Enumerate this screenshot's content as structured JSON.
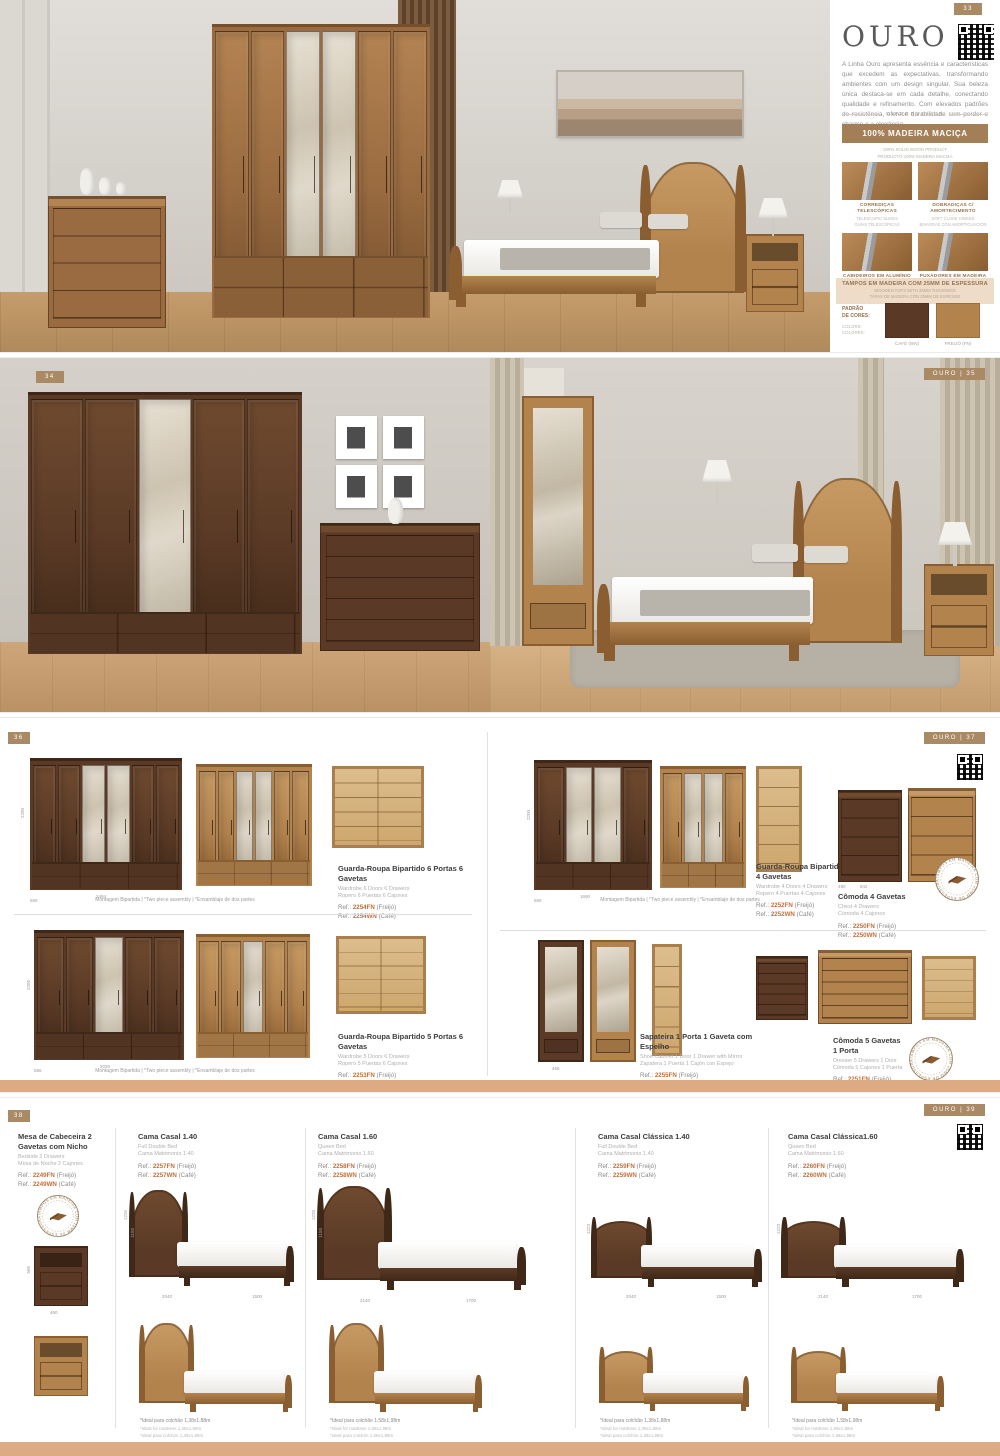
{
  "badges": {
    "p1": "33",
    "p2l": "34",
    "p2r": "OURO | 35",
    "p3l": "36",
    "p3r": "OURO | 37",
    "p4l": "38",
    "p4r": "OURO | 39"
  },
  "labels": {
    "ref": "Ref.:",
    "fin_fn": "(Freijó)",
    "fin_wn": "(Café)"
  },
  "seal_text": "TAMPOS EM MADEIRA COM 25MM DE ESPESSURA •",
  "notes": {
    "montagem": "Montagem Bipartida | *Two piece assembly | *Ensamblaje de dos partes"
  },
  "colors": {
    "accent_tan": "#a98a64",
    "banner_brown": "#a37f58",
    "ref_orange": "#c0703c",
    "light_tan": "#eedbc8",
    "strip_tan": "#dcab83",
    "cafe_wood": "#5a3a26",
    "freijo_wood": "#b3834e"
  },
  "sidebar": {
    "title": "OURO",
    "description": "A Linha Ouro apresenta essência e características que excedem as expectativas, transformando ambientes com um design singular. Sua beleza única destaca-se em cada detalhe, conectando qualidade e refinamento. Com elevados padrões de resistência, oferece durabilidade sem perder o charme e a elegância.",
    "divider": "DIFERENCIAIS",
    "banner": "100% MADEIRA MACIÇA",
    "banner_sub1": "100% SOLID WOOD PRODUCT",
    "banner_sub2": "PRODUCTO 100% MADERA MACIZA",
    "features": [
      {
        "title": "CORREDIÇAS TELESCÓPICAS",
        "sub1": "TELESCOPIC SLIDES",
        "sub2": "GUÍAS TELESCÓPICAS"
      },
      {
        "title": "DOBRADIÇAS C/ AMORTECIMENTO",
        "sub1": "SOFT CLOSE HINGES",
        "sub2": "BISAGRAS CON AMORTIGUACIÓN"
      },
      {
        "title": "CABIDEIROS EM ALUMÍNIO",
        "sub1": "ALUMINUM CLOTHES ROD",
        "sub2": "SOPORTE PARA PERCHAS DE ALUMÍNIO"
      },
      {
        "title": "PUXADORES EM MADEIRA",
        "sub1": "SOLID WOOD HANDLES",
        "sub2": "MANIJAS DE MADERA MACIZA"
      }
    ],
    "tops_banner": "TAMPOS EM MADEIRA COM 25MM DE ESPESSURA",
    "tops_sub1": "WOODEN TOPS WITH 25MM THICKNESS",
    "tops_sub2": "TAPAS DE MADERA CON 25MM DE ESPESOR",
    "colors_label_pt": "PADRÃO\nDE CORES:",
    "colors_label_intl": "COLORS:\nCOLORES:",
    "swatch1": "CAFÉ (WN)",
    "swatch2": "FREIJÓ (FN)"
  },
  "p3": {
    "products": [
      {
        "title": "Guarda-Roupa Bipartido 6 Portas 6 Gavetas",
        "en": "Wardrobe 6 Doors 6 Drawers",
        "es": "Ropero 6 Puertas 6 Cajones",
        "fn": "2254FN",
        "wn": "2254WN"
      },
      {
        "title": "Guarda-Roupa Bipartido 4 Portas 4 Gavetas",
        "en": "Wardrobe 4 Doors 4 Drawers",
        "es": "Ropero 4 Puertas 4 Cajones",
        "fn": "2252FN",
        "wn": "2252WN"
      },
      {
        "title": "Cômoda 4 Gavetas",
        "en": "Chest 4 Drawers",
        "es": "Cómoda 4 Cajones",
        "fn": "2250FN",
        "wn": "2250WN"
      },
      {
        "title": "Guarda-Roupa Bipartido 5 Portas 6 Gavetas",
        "en": "Wardrobe 5 Doors 6 Drawers",
        "es": "Ropero 5 Puertas 6 Cajones",
        "fn": "2253FN",
        "wn": "2253WN"
      },
      {
        "title": "Sapateira 1 Porta 1 Gaveta com Espelho",
        "en": "Shoe Cabinet 1 Door 1 Drawer with Mirror",
        "es": "Zapatera 1 Puerta 1 Cajón con Espejo",
        "fn": "2255FN",
        "wn": "2255WN"
      },
      {
        "title": "Cômoda 5 Gavetas 1 Porta",
        "en": "Dresser 5 Drawers 1 Door",
        "es": "Cómoda 5 Cajones 1 Puerta",
        "fn": "2251FN",
        "wn": "2251WN"
      }
    ],
    "dims": {
      "w6h": "2200",
      "w6w": "2494",
      "w6d": "555",
      "w5h": "2200",
      "w5w": "2030",
      "w5d": "555",
      "w4h": "2200",
      "w4w": "1690",
      "w4d": "555",
      "cm4w": "842",
      "cm4d": "490",
      "sapd": "465"
    }
  },
  "p4": {
    "products": [
      {
        "title": "Mesa de Cabeceira 2 Gavetas com Nicho",
        "en": "Bedside 2 Drawers",
        "es": "Mesa de Noche 2 Cajones",
        "fn": "2249FN",
        "wn": "2249WN"
      },
      {
        "title": "Cama Casal 1.40",
        "en": "Full Double Bed",
        "es": "Cama Matrimonio 1.40",
        "fn": "2257FN",
        "wn": "2257WN",
        "foot_pt": "*Ideal para colchão 1,38x1,88m",
        "foot_en": "*Ideal for mattress 1,38x1,88m",
        "foot_es": "*Ideal para colchón 1,38x1,88m"
      },
      {
        "title": "Cama Casal 1.60",
        "en": "Queen Bed",
        "es": "Cama Matrimonio 1.60",
        "fn": "2258FN",
        "wn": "2258WN",
        "foot_pt": "*Ideal para colchão 1,58x1,98m",
        "foot_en": "*Ideal for mattress 1,58x1,98m",
        "foot_es": "*Ideal para colchón 1,58x1,98m"
      },
      {
        "title": "Cama Casal Clássica 1.40",
        "en": "Full Double Bed",
        "es": "Cama Matrimonio 1.40",
        "fn": "2259FN",
        "wn": "2259WN",
        "foot_pt": "*Ideal para colchão 1,38x1,88m",
        "foot_en": "*Ideal for mattress 1,38x1,88m",
        "foot_es": "*Ideal para colchón 1,38x1,88m"
      },
      {
        "title": "Cama Casal Clássica1.60",
        "en": "Queen Bed",
        "es": "Cama Matrimonio 1.60",
        "fn": "2260FN",
        "wn": "2260WN",
        "foot_pt": "*Ideal para colchão 1,58x1,98m",
        "foot_en": "*Ideal for mattress 1,58x1,98m",
        "foot_es": "*Ideal para colchón 1,58x1,98m"
      }
    ],
    "dims": {
      "nsh": "565",
      "nsw": "460",
      "b140h1": "1225",
      "b140h2": "1150",
      "b140l": "2040",
      "b140w": "1500",
      "b160l": "2140",
      "b160w": "1700",
      "bch": "1223"
    }
  }
}
